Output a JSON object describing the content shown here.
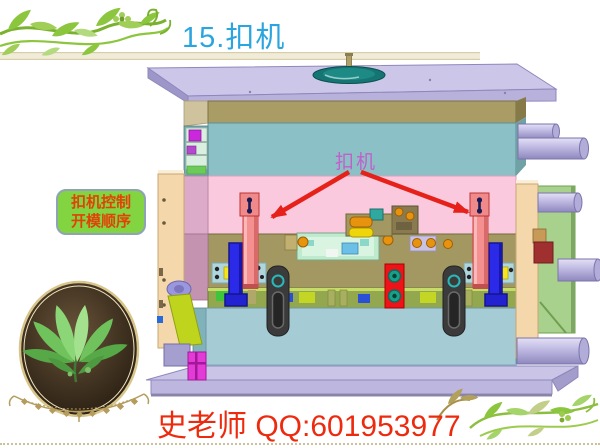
{
  "slide": {
    "title": "15.扣机",
    "footer": "史老师 QQ:601953977"
  },
  "callout": {
    "line1": "扣机控制",
    "line2": "开模顺序"
  },
  "annotation": {
    "label": "扣机"
  },
  "colors": {
    "title_blue": "#2BA5DF",
    "callout_fill": "#82D441",
    "callout_text": "#E24207",
    "annotation_magenta": "#C25FCA",
    "arrow_red": "#E6211A",
    "footer_red": "#ED2A0D",
    "vine_green": "#8CC63F",
    "gold_ornament": "#B49C5C",
    "mold_clamp_plate_lavender": "#CCC7E9",
    "mold_a_plate_tan": "#A99D65",
    "mold_cavity_teal": "#8BC1C6",
    "mold_pink_plate": "#FAC9DD",
    "mold_support_blue": "#A5CBD5",
    "latch_bar_red": "#F59090",
    "rail_blue": "#2A2AE8",
    "ejector_plate_red": "#EE1318"
  }
}
